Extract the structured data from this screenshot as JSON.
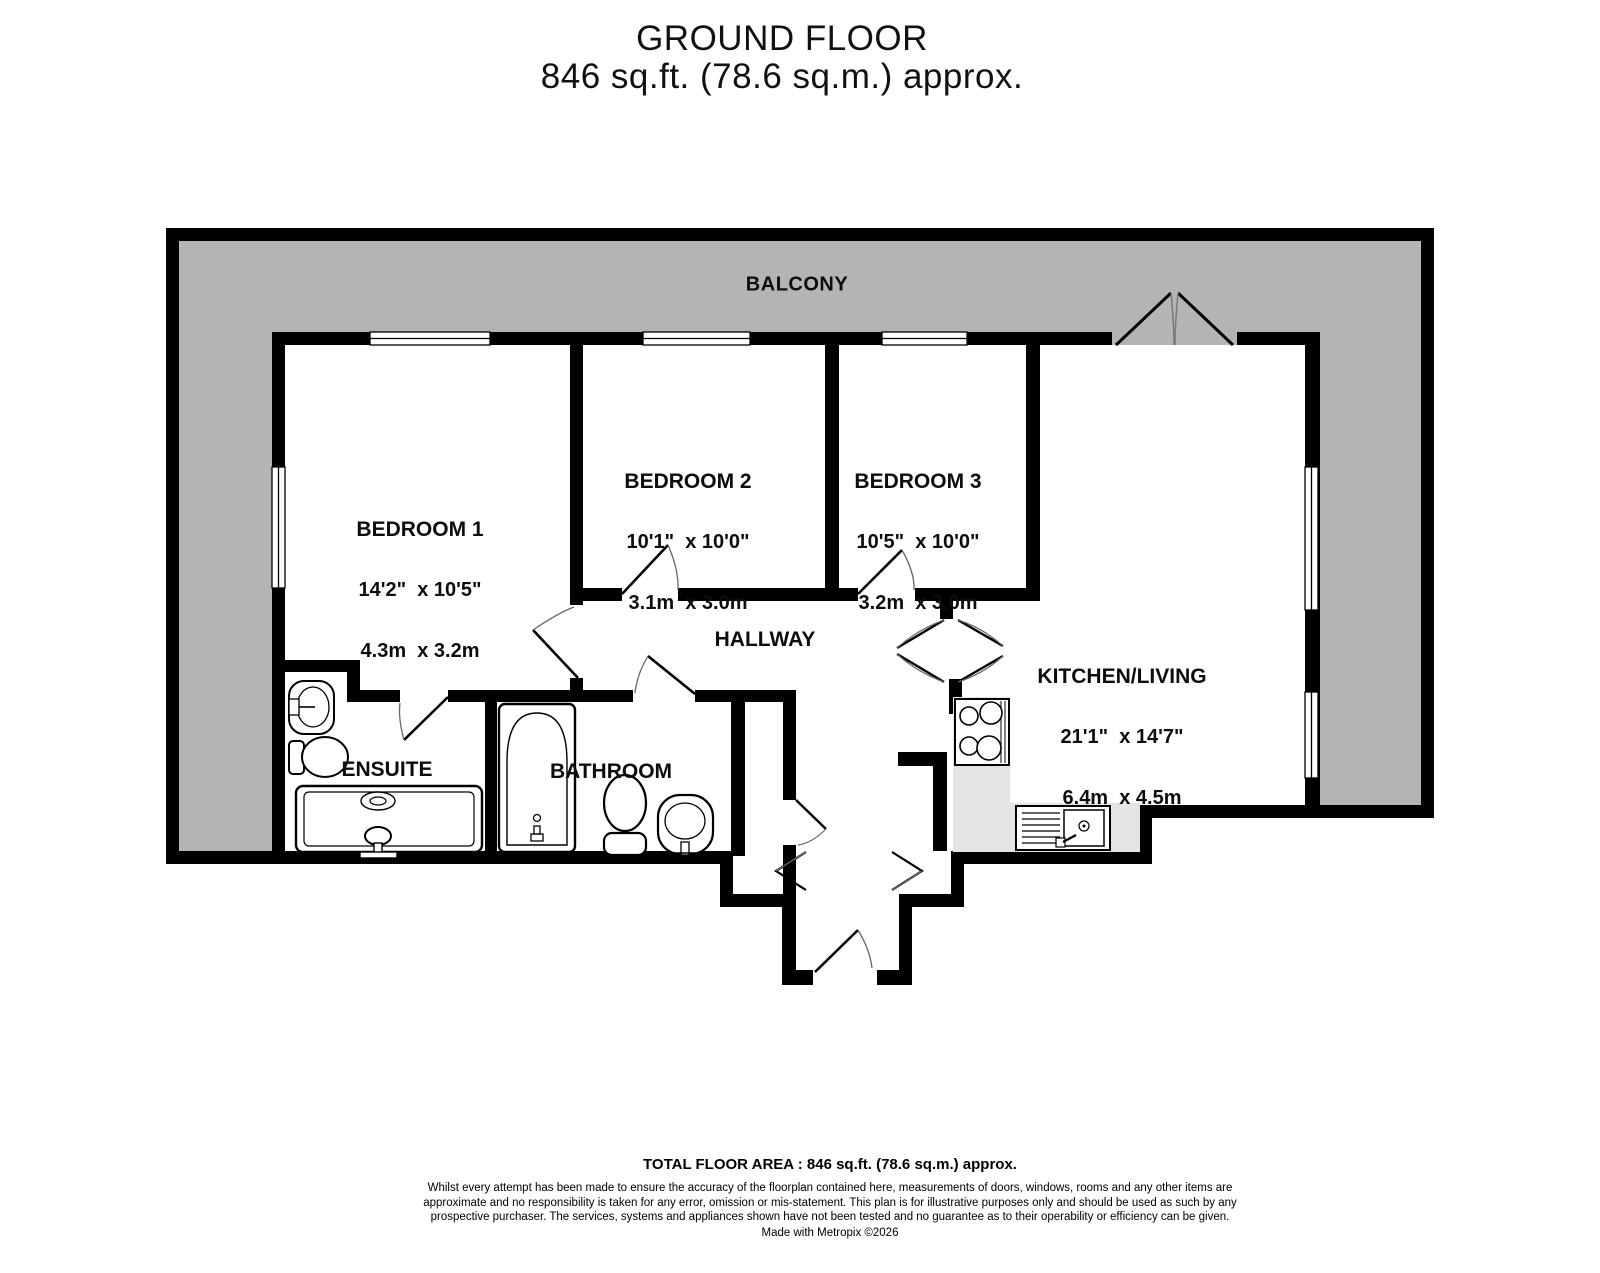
{
  "header": {
    "title": "GROUND FLOOR",
    "subtitle": "846 sq.ft. (78.6 sq.m.) approx."
  },
  "plan": {
    "balcony_label": "BALCONY",
    "rooms": [
      {
        "name": "BEDROOM 1",
        "imperial": "14'2\"  x 10'5\"",
        "metric": "4.3m  x 3.2m"
      },
      {
        "name": "BEDROOM 2",
        "imperial": "10'1\"  x 10'0\"",
        "metric": "3.1m  x 3.0m"
      },
      {
        "name": "BEDROOM 3",
        "imperial": "10'5\"  x 10'0\"",
        "metric": "3.2m  x 3.0m"
      },
      {
        "name": "KITCHEN/LIVING",
        "imperial": "21'1\"  x 14'7\"",
        "metric": "6.4m  x 4.5m"
      },
      {
        "name": "HALLWAY"
      },
      {
        "name": "ENSUITE"
      },
      {
        "name": "BATHROOM"
      }
    ]
  },
  "footer": {
    "total": "TOTAL FLOOR AREA : 846 sq.ft. (78.6 sq.m.) approx.",
    "disclaimer": "Whilst every attempt has been made to ensure the accuracy of the floorplan contained here, measurements of doors, windows, rooms and any other items are approximate and no responsibility is taken for any error, omission or mis-statement. This plan is for illustrative purposes only and should be used as such by any prospective purchaser. The services, systems and appliances shown have not been tested and no guarantee as to their operability or efficiency can be given.",
    "credit": "Made with Metropix ©2026"
  },
  "colors": {
    "wall": "#000000",
    "balcony": "#b4b4b4",
    "counter": "#e4e4e4"
  }
}
